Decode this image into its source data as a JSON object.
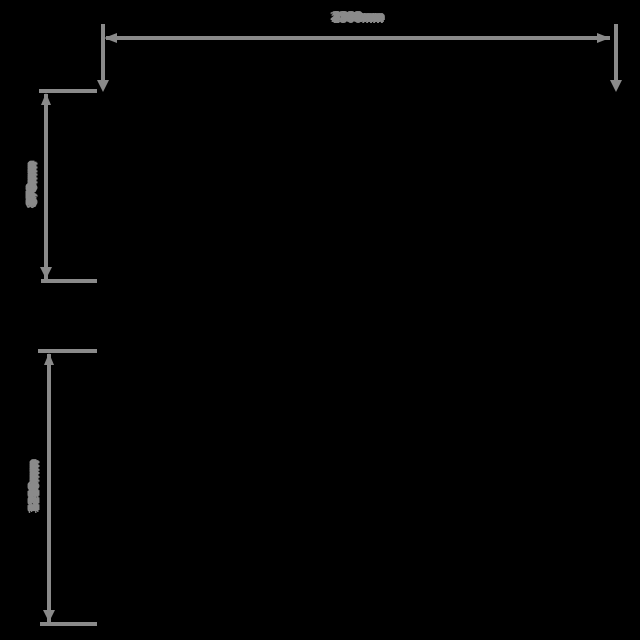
{
  "figure": {
    "type": "dimension-drawing",
    "background_color": "#000000",
    "line_color": "#8a8a8a",
    "text_color": "#8a8a8a",
    "unit": "mm"
  },
  "dimensions": {
    "top_width": {
      "label": "2300mm",
      "orientation": "horizontal"
    },
    "upper_left_height": {
      "label": "870mm",
      "orientation": "vertical"
    },
    "lower_left_height": {
      "label": "1210mm",
      "orientation": "vertical"
    }
  }
}
